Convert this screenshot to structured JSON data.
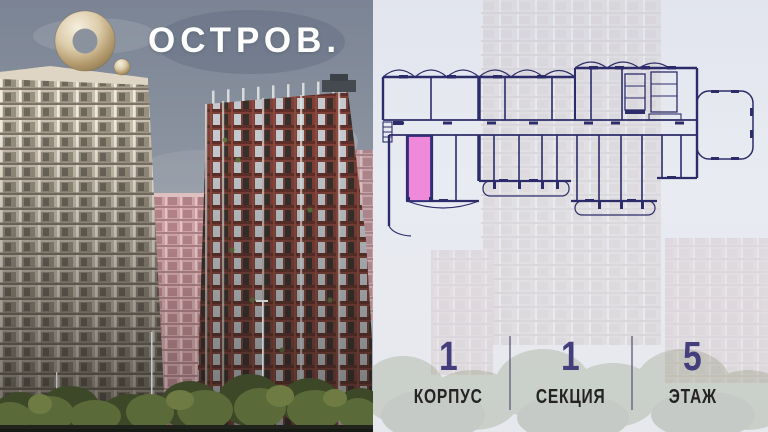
{
  "brand": {
    "logo_text": "ОСТРОВ.",
    "logo_icon": "gold-ring-logo"
  },
  "floor_plan": {
    "name": "section-floor-plan",
    "highlighted_unit": "selected-apartment",
    "highlight_color": "#ee8ad9",
    "line_color": "#2d2c6a"
  },
  "info": {
    "items": [
      {
        "value": "1",
        "label": "КОРПУС"
      },
      {
        "value": "1",
        "label": "СЕКЦИЯ"
      },
      {
        "value": "5",
        "label": "ЭТАЖ"
      }
    ]
  },
  "colors": {
    "accent_pink": "#ee8ad9",
    "plan_navy": "#2d2c6a",
    "number_indigo": "#443e7d",
    "label_dark": "#232323",
    "logo_gold": "#d9c8a4",
    "sky_gray": "#8d95a1"
  }
}
